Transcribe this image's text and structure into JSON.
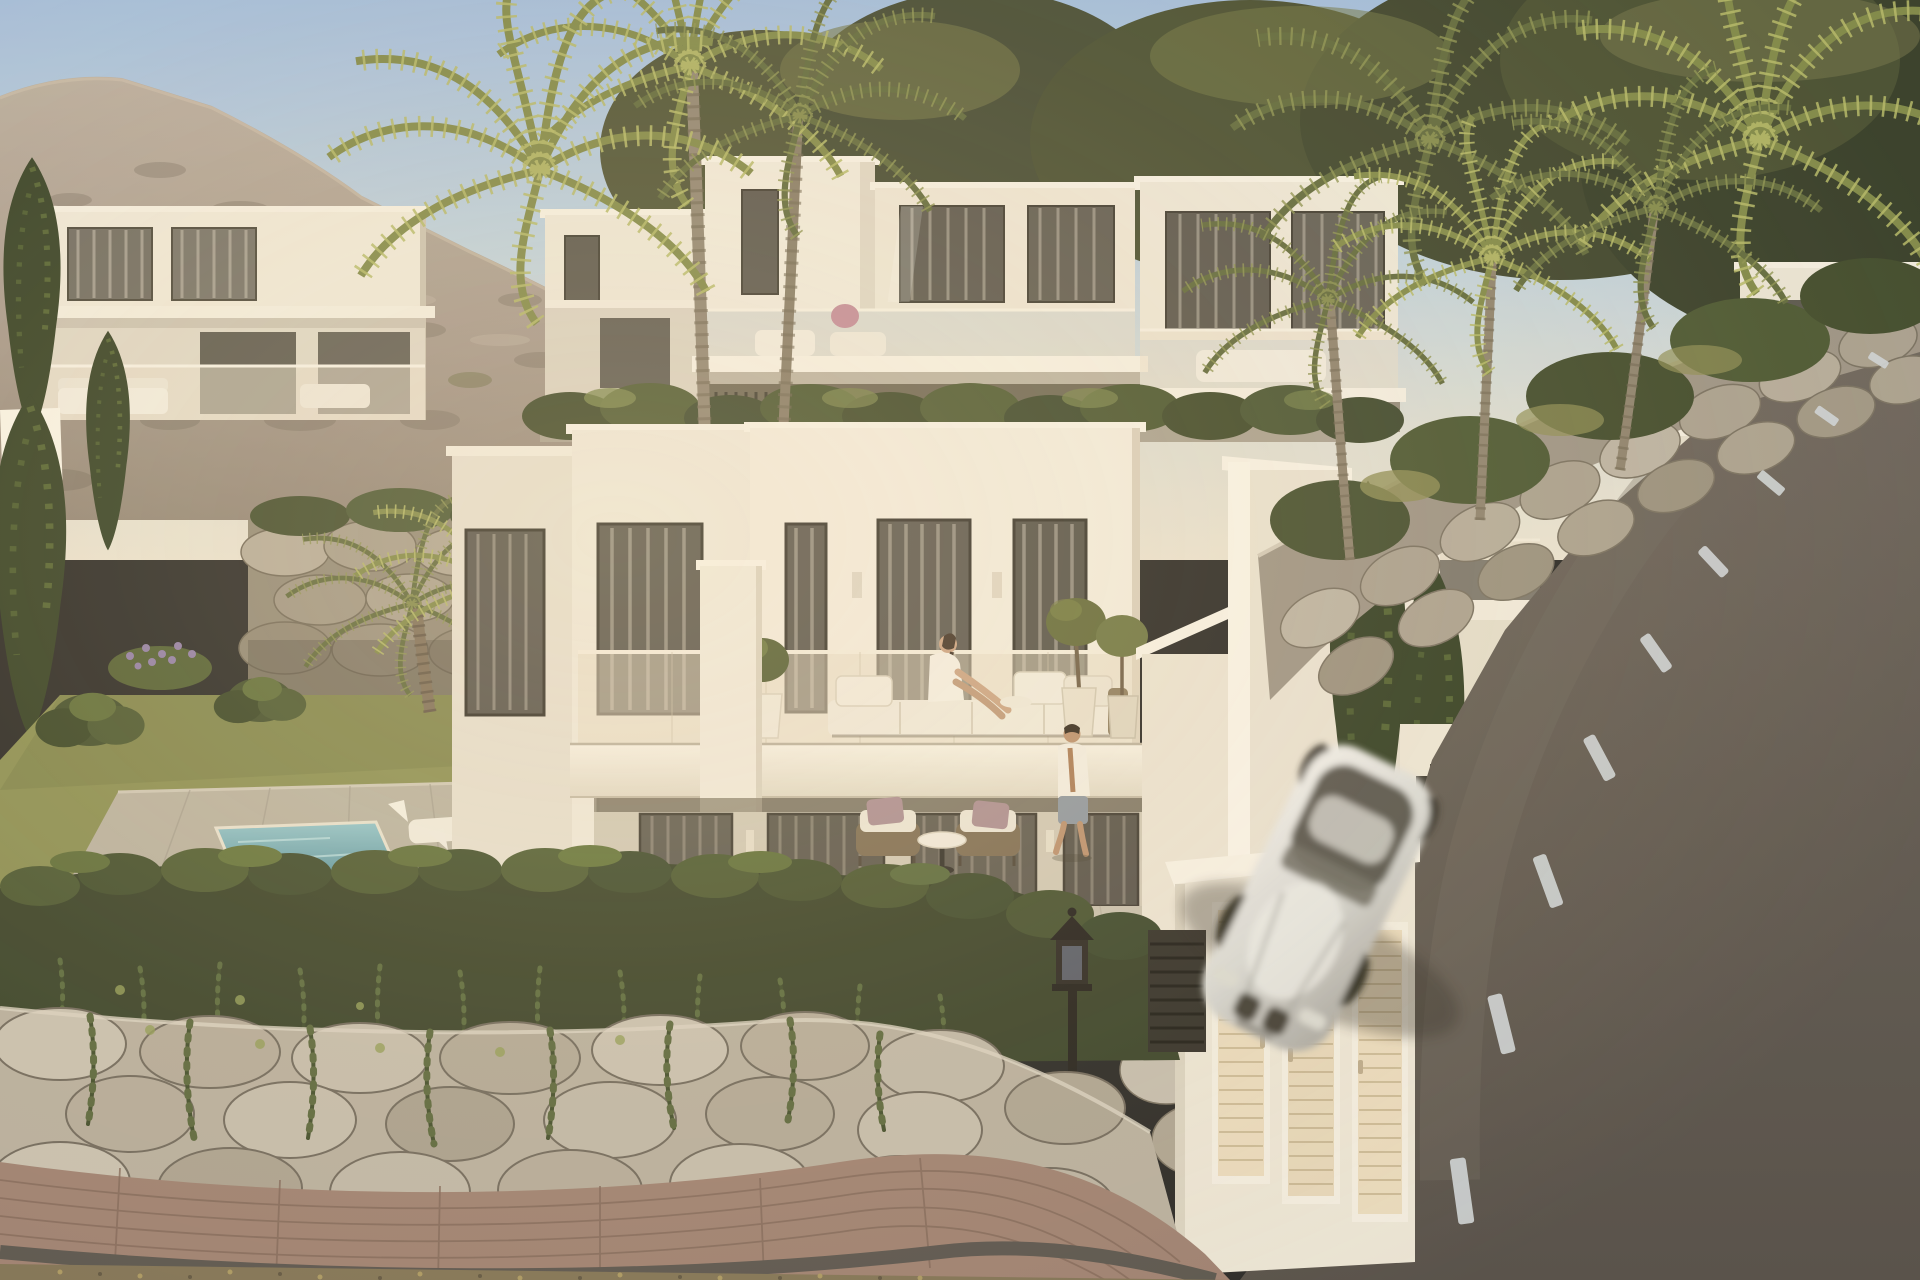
{
  "scene": {
    "title": "Golden-hour architectural rendering of modern white hillside villas with palm trees, plunge pool, stone retaining walls and a silver coupe on the road",
    "labels": {
      "sky": "Clear pale-blue evening sky",
      "mountain": "Rocky scrubland mountain slope behind the villas",
      "background_trees": "Dense dark-green tree canopy behind the buildings",
      "background_villas": "Row of white flat-roofed villas with glass balustrade terraces",
      "main_villa": "Two-storey white villa of the foreground duplex",
      "roof_terrace": "First-floor terrace with glass balustrade, white modular sofa and potted olive trees",
      "lower_terrace": "Ground-floor covered terrace with two armchairs and a round coffee table",
      "woman": "Woman in a white robe lounging on the terrace sofa",
      "man": "Man in an open white shirt and grey shorts walking on the lower terrace",
      "garden": "Private garden with lawn, lavender and palms",
      "pool": "Rectangular plunge pool with stone deck and two sun loungers",
      "hedge": "Ivy hedge running along the plot boundary",
      "foreground_wall": "Dry-stone retaining wall with hanging ivy at the street edge",
      "right_wall": "Dry-stone wall bordering the uphill road",
      "boundary_wall": "White rendered boundary wall with bright coping",
      "gate": "White entrance block with three louvered timber doors",
      "privacy_fence": "Dark metal slatted fence with stepped top",
      "garage_door": "White sectional garage door",
      "keypad_post": "White post with black video intercom",
      "street_lamp": "Black lantern street lamp",
      "road": "Asphalt road with dashed centre line curving uphill",
      "sidewalk": "Curved clay-brick sidewalk band",
      "car": "Motion-blurred silver coupe driving downhill",
      "palms": "Tall palm trees",
      "cypresses": "Dark green columnar cypresses",
      "olive_tree": "Olive tree in the upper garden"
    },
    "people": [
      {
        "who": "woman",
        "pose": "reclining on sofa, face to the sun",
        "clothing": "white robe"
      },
      {
        "who": "man",
        "pose": "walking, hands near pockets",
        "clothing": "open white shirt, grey-blue shorts"
      }
    ],
    "objects": {
      "gate_doors": 3,
      "garage_door_panels": 5,
      "terrace_sofa_seats": 4,
      "lower_terrace_armchairs": 2,
      "armchair_pillow_color": "mauve",
      "sun_loungers": 2,
      "potted_olive_trees": 2,
      "road_dashes": 9,
      "street_lamps": 1,
      "cars": 1
    },
    "palette": {
      "sky_top": "#9fbbdd",
      "sky_horizon": "#e9e2d2",
      "mountain": "#a2958a",
      "villa_sunlit": "#f4efe4",
      "villa_shadow": "#d9d2c4",
      "window_glass": "#55524b",
      "curtain": "#b5aea1",
      "terrace_glass": "#e3d7c2",
      "ivy_dark": "#2e3a22",
      "ivy_light": "#5a6a36",
      "palm_gold": "#9aa055",
      "stone_light": "#c6bfb0",
      "stone_shadow": "#8d8473",
      "pool_water": "#5d98a8",
      "road_asphalt": "#5d564f",
      "road_marking": "#ccd2d6",
      "brick_paving": "#9b7d6f",
      "car_silver": "#d6d6d4",
      "gate_timber": "#e8d9bd",
      "fence_dark": "#35322c",
      "lamp_black": "#1d1b18"
    }
  }
}
